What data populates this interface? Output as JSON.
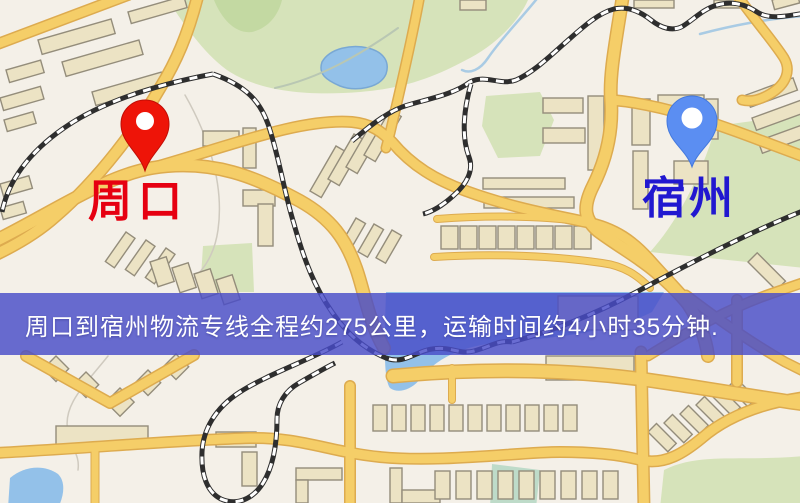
{
  "banner": {
    "text": "周口到宿州物流专线全程约275公里，运输时间约4小时35分钟.",
    "background_color": "#4b4ec9",
    "text_color": "#ffffff"
  },
  "route_info": {
    "origin": "周口",
    "destination": "宿州",
    "distance_text": "约275公里",
    "duration_text": "约4小时35分钟"
  },
  "map": {
    "markers": [
      {
        "name": "origin",
        "label": "周口",
        "pin_color": "#ee1408",
        "label_color": "#e60011"
      },
      {
        "name": "destination",
        "label": "宿州",
        "pin_color": "#5b8ef2",
        "label_color": "#2118d0"
      }
    ],
    "palette": {
      "background": "#f4f0e8",
      "road": "#f5ce68",
      "road_casing": "#ddab4f",
      "building": "#ece3c4",
      "building_outline": "#948d7b",
      "park": "#d6e3ba",
      "water": "#93c1e9",
      "railway": "#2e2e2e"
    }
  }
}
